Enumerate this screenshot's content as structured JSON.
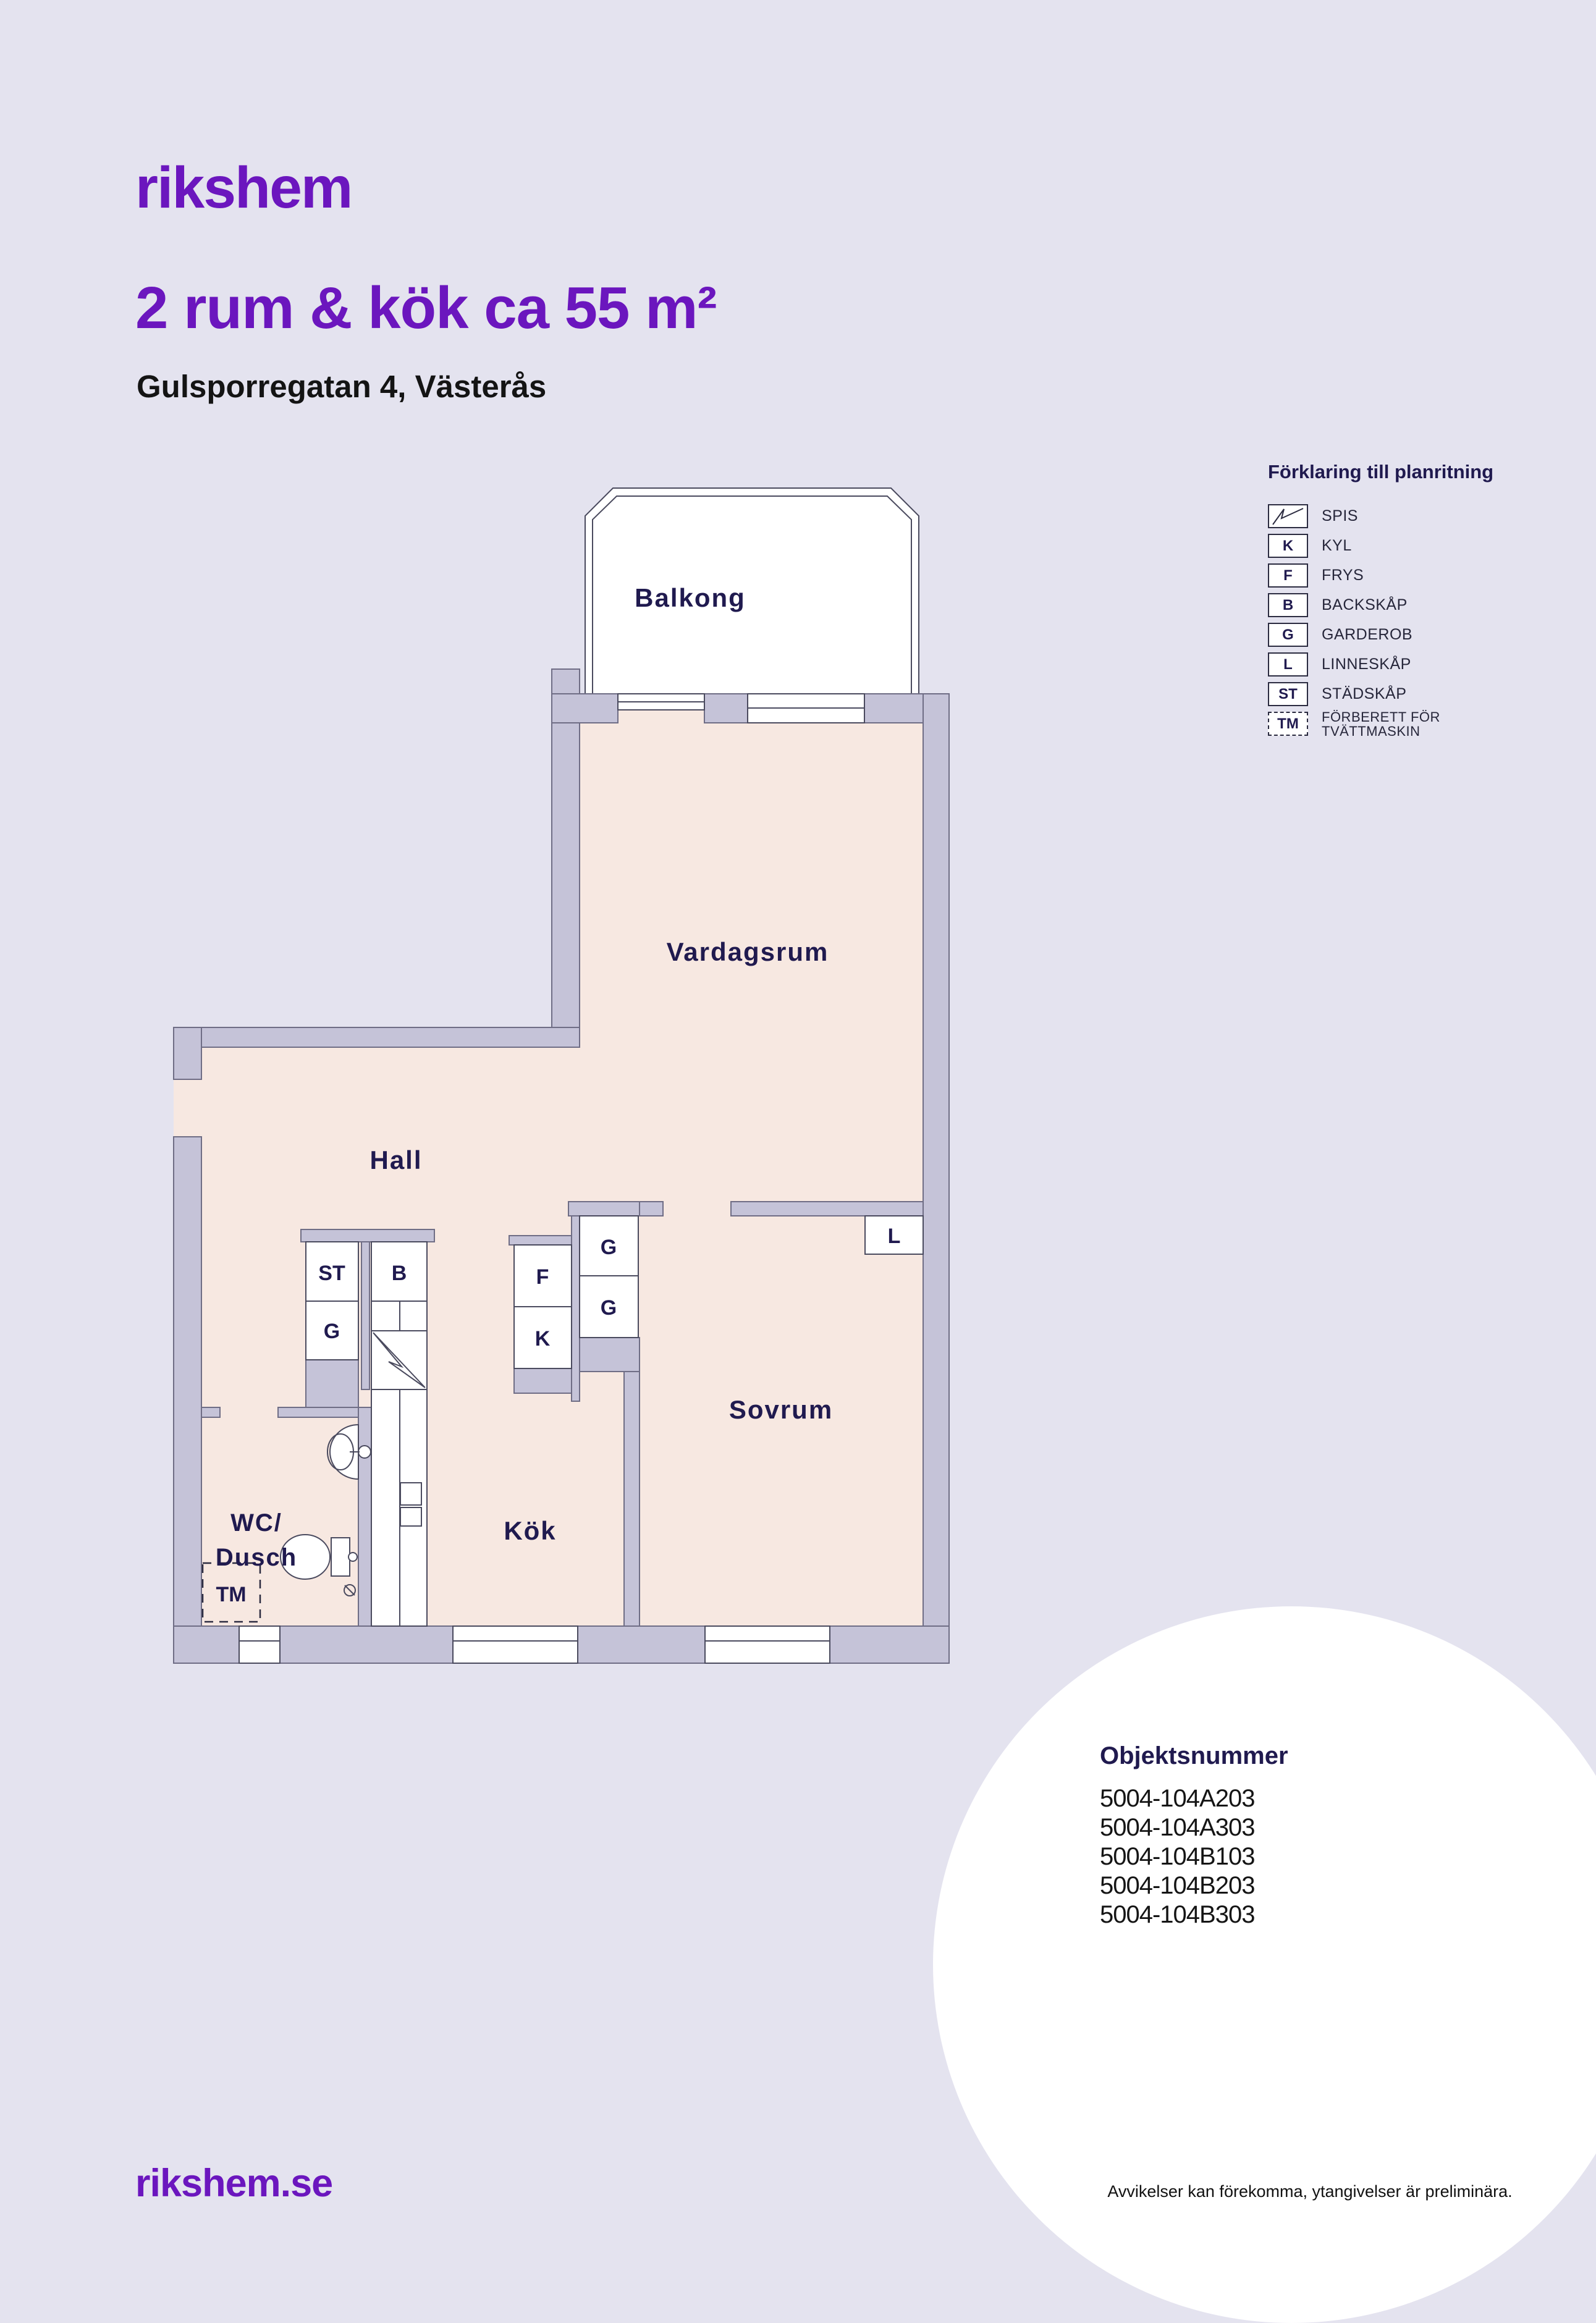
{
  "header": {
    "logo": "rikshem",
    "title": "2 rum & kök ca 55 m²",
    "subtitle": "Gulsporregatan 4, Västerås"
  },
  "legend": {
    "heading": "Förklaring till planritning",
    "items": [
      {
        "symbol": "",
        "label": "SPIS"
      },
      {
        "symbol": "K",
        "label": "KYL"
      },
      {
        "symbol": "F",
        "label": "FRYS"
      },
      {
        "symbol": "B",
        "label": "BACKSKÅP"
      },
      {
        "symbol": "G",
        "label": "GARDEROB"
      },
      {
        "symbol": "L",
        "label": "LINNESKÅP"
      },
      {
        "symbol": "ST",
        "label": "STÄDSKÅP"
      },
      {
        "symbol": "TM",
        "label1": "FÖRBERETT FÖR",
        "label2": "TVÄTTMASKIN"
      }
    ]
  },
  "plan": {
    "rooms": {
      "balkong": "Balkong",
      "vardagsrum": "Vardagsrum",
      "hall": "Hall",
      "sovrum": "Sovrum",
      "kok": "Kök",
      "wc_line1": "WC/",
      "wc_line2": "Dusch"
    },
    "closets": {
      "st": "ST",
      "g_hall": "G",
      "b": "B",
      "f": "F",
      "k": "K",
      "g_upper": "G",
      "g_lower": "G",
      "l": "L",
      "tm": "TM"
    }
  },
  "objekt": {
    "heading": "Objektsnummer",
    "numbers": [
      "5004-104A203",
      "5004-104A303",
      "5004-104B103",
      "5004-104B203",
      "5004-104B303"
    ]
  },
  "footer": {
    "site": "rikshem.se",
    "disclaimer": "Avvikelser kan förekomma, ytangivelser är preliminära."
  },
  "colors": {
    "background": "#E4E3EF",
    "wall": "#C5C3D8",
    "floor": "#F7E8E1",
    "brand_purple": "#6B16BE",
    "navy": "#201A4F"
  }
}
